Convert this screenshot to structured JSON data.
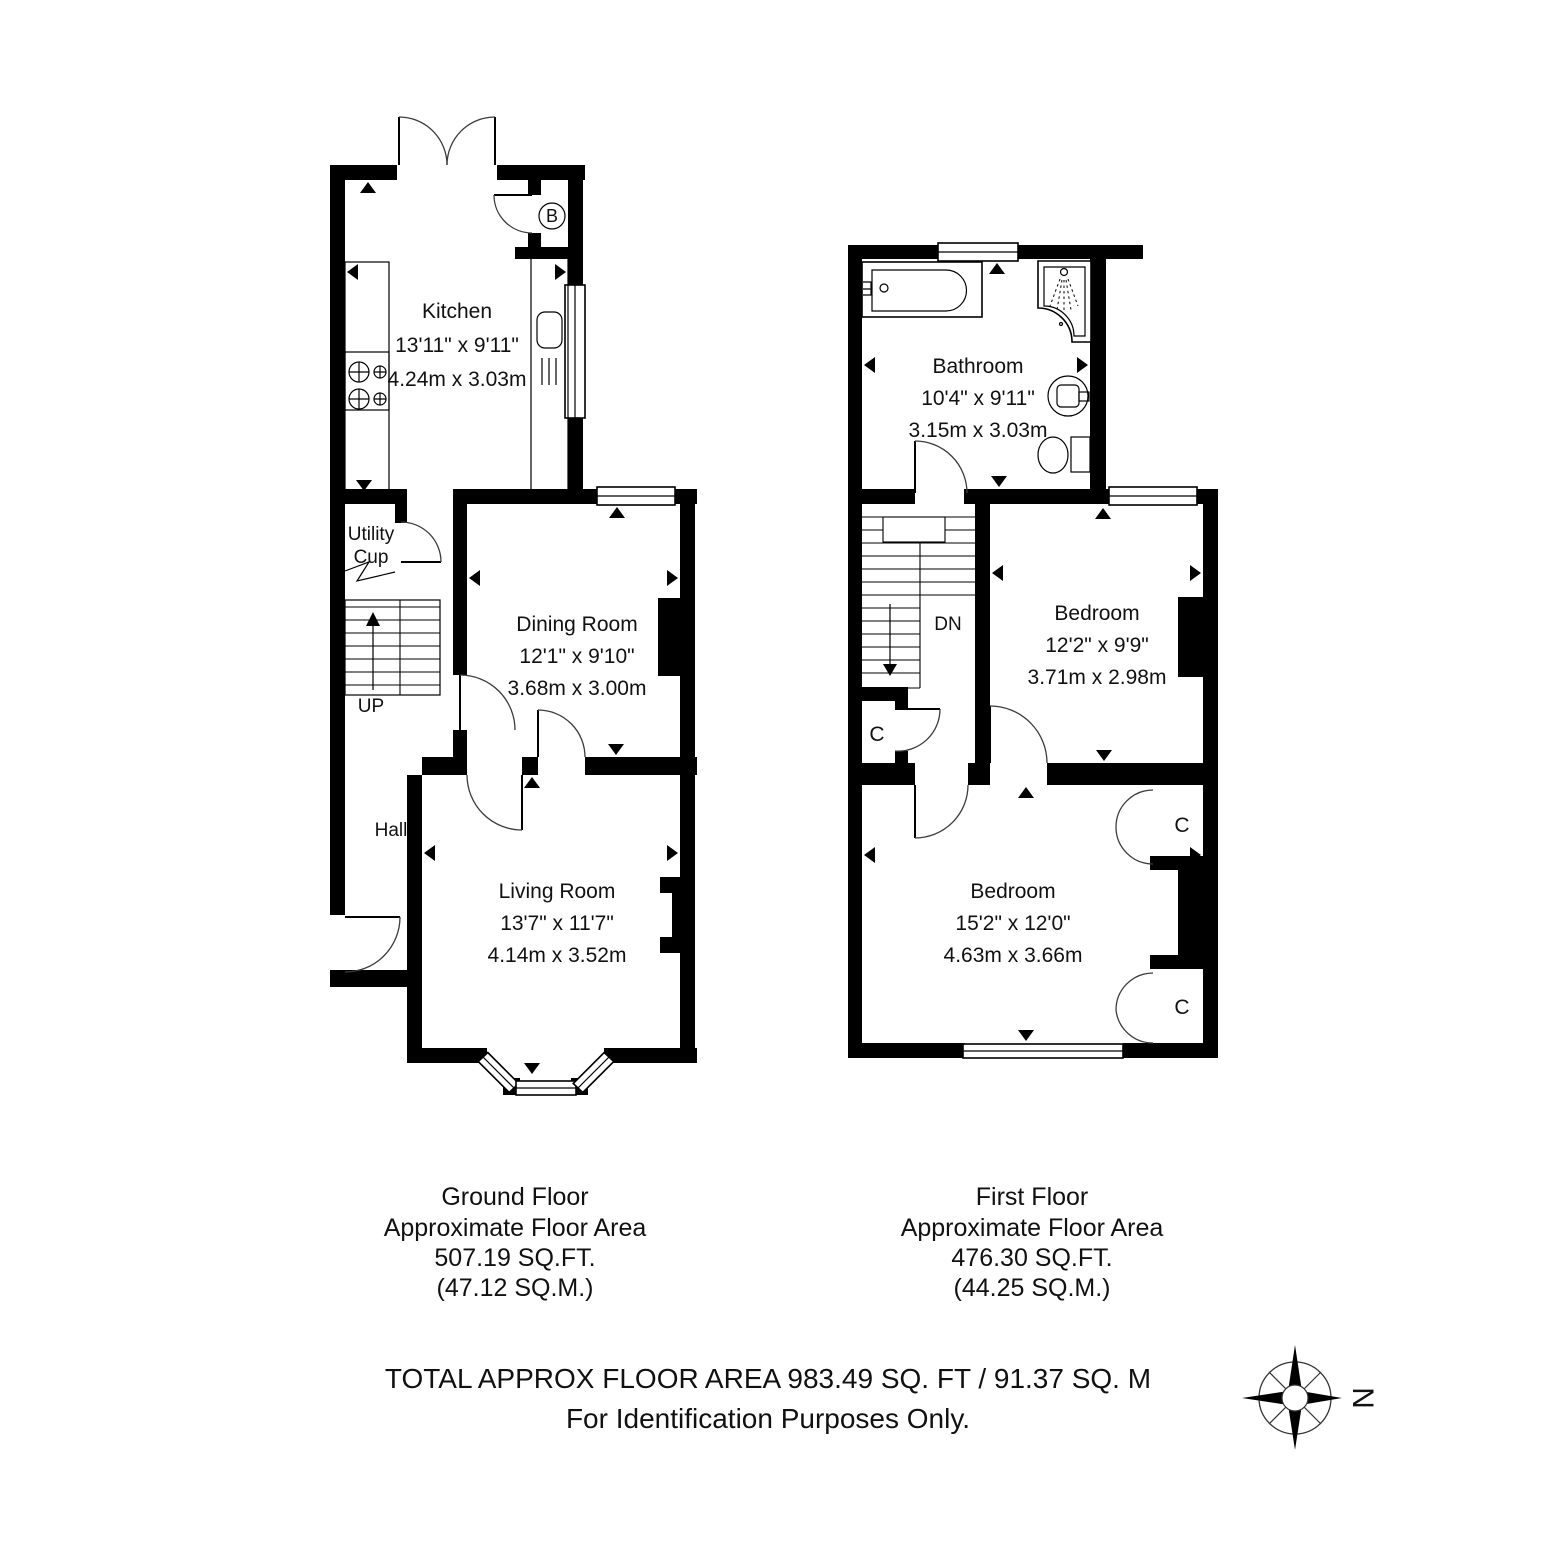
{
  "document": {
    "type": "floorplan"
  },
  "ground_floor": {
    "caption": {
      "line1": "Ground Floor",
      "line2": "Approximate Floor Area",
      "line3": "507.19 SQ.FT.",
      "line4": "(47.12 SQ.M.)"
    },
    "kitchen": {
      "name": "Kitchen",
      "imperial": "13'11\" x 9'11\"",
      "metric": "4.24m x 3.03m"
    },
    "dining_room": {
      "name": "Dining Room",
      "imperial": "12'1\" x 9'10\"",
      "metric": "3.68m x 3.00m"
    },
    "living_room": {
      "name": "Living Room",
      "imperial": "13'7\" x 11'7\"",
      "metric": "4.14m x 3.52m"
    },
    "hall": {
      "name": "Hall"
    },
    "utility_cupboard": {
      "line1": "Utility",
      "line2": "Cup"
    },
    "stairs": {
      "label": "UP"
    },
    "boiler": {
      "label": "B"
    }
  },
  "first_floor": {
    "caption": {
      "line1": "First Floor",
      "line2": "Approximate Floor Area",
      "line3": "476.30 SQ.FT.",
      "line4": "(44.25 SQ.M.)"
    },
    "bathroom": {
      "name": "Bathroom",
      "imperial": "10'4\" x 9'11\"",
      "metric": "3.15m x 3.03m"
    },
    "bedroom_rear": {
      "name": "Bedroom",
      "imperial": "12'2\" x 9'9\"",
      "metric": "3.71m x 2.98m"
    },
    "bedroom_front": {
      "name": "Bedroom",
      "imperial": "15'2\" x 12'0\"",
      "metric": "4.63m x 3.66m"
    },
    "stairs": {
      "label": "DN"
    },
    "closet_landing": {
      "label": "C"
    },
    "closet_rear": {
      "label": "C"
    },
    "closet_front": {
      "label": "C"
    }
  },
  "footer": {
    "total": "TOTAL APPROX FLOOR AREA 983.49 SQ. FT / 91.37 SQ. M",
    "disclaimer": "For Identification Purposes Only.",
    "compass": {
      "label": "N"
    }
  }
}
